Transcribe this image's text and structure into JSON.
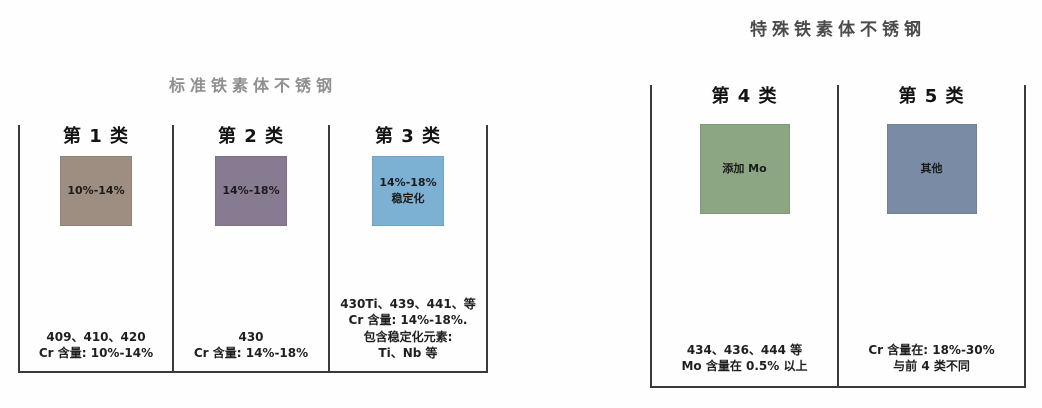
{
  "line_color": "#3a3a3a",
  "groups": [
    {
      "title": "标准铁素体不锈钢",
      "columns": [
        {
          "header": "第 1 类",
          "box_label": "10%-14%",
          "box_color": "#9e8d81",
          "notes": [
            "409、410、420",
            "Cr 含量: 10%-14%"
          ]
        },
        {
          "header": "第 2 类",
          "box_label": "14%-18%",
          "box_color": "#867b90",
          "notes": [
            "430",
            "Cr 含量: 14%-18%"
          ]
        },
        {
          "header": "第 3 类",
          "box_label": "14%-18%\n稳定化",
          "box_color": "#7db1d4",
          "notes": [
            "430Ti、439、441、等",
            "Cr 含量: 14%-18%.",
            "包含稳定化元素:",
            "Ti、Nb 等"
          ]
        }
      ]
    },
    {
      "title": "特殊铁素体不锈钢",
      "columns": [
        {
          "header": "第 4 类",
          "box_label": "添加 Mo",
          "box_color": "#8ca684",
          "notes": [
            "434、436、444 等",
            "Mo 含量在 0.5% 以上"
          ]
        },
        {
          "header": "第 5 类",
          "box_label": "其他",
          "box_color": "#7a8ca5",
          "notes": [
            "Cr 含量在: 18%-30%",
            "与前 4 类不同"
          ]
        }
      ]
    }
  ]
}
